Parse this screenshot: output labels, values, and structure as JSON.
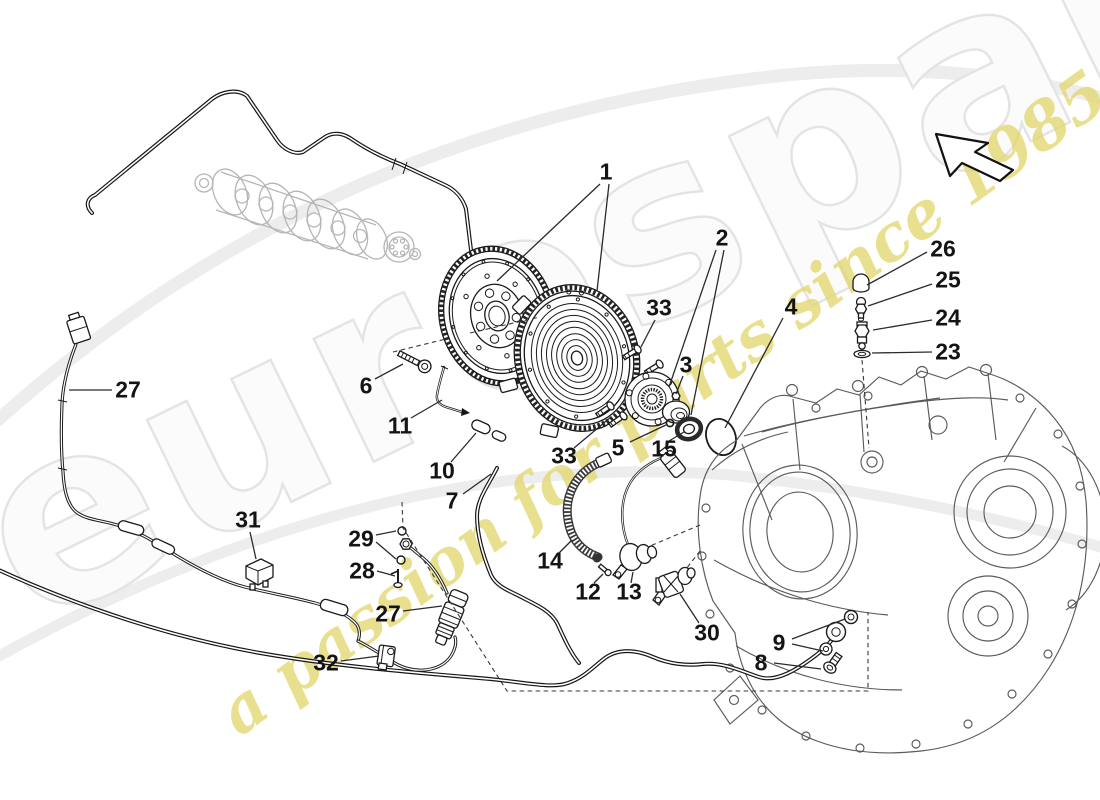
{
  "watermark": {
    "brand": "eurospares",
    "tagline": "a passion for parts since 1985",
    "brand_color": "#f0f0f0",
    "tagline_color": "#e2d76e"
  },
  "colors": {
    "background": "#ffffff",
    "line_art": "#1a1a1a",
    "housing_gray": "#5b5b5b",
    "crankshaft_gray": "#b6b6b6",
    "swoosh_gray": "#ededed",
    "label_text": "#141414"
  },
  "icons": {
    "direction_arrow": "arrow-up-left-icon"
  },
  "callouts": [
    {
      "text": "1",
      "x": 606,
      "y": 172,
      "leaders": [
        [
          600,
          184,
          497,
          281
        ],
        [
          609,
          184,
          597,
          291
        ]
      ]
    },
    {
      "text": "2",
      "x": 722,
      "y": 238,
      "leaders": [
        [
          716,
          250,
          669,
          387
        ],
        [
          724,
          250,
          691,
          415
        ]
      ]
    },
    {
      "text": "3",
      "x": 686,
      "y": 365,
      "leaders": [
        [
          683,
          376,
          676,
          394
        ]
      ]
    },
    {
      "text": "4",
      "x": 791,
      "y": 307,
      "leaders": [
        [
          783,
          318,
          725,
          428
        ]
      ]
    },
    {
      "text": "5",
      "x": 618,
      "y": 448,
      "leaders": [
        [
          630,
          442,
          666,
          425
        ]
      ]
    },
    {
      "text": "6",
      "x": 366,
      "y": 386,
      "leaders": [
        [
          375,
          379,
          403,
          364
        ]
      ]
    },
    {
      "text": "7",
      "x": 452,
      "y": 501,
      "leaders": [
        [
          463,
          494,
          491,
          474
        ]
      ]
    },
    {
      "text": "8",
      "x": 761,
      "y": 663,
      "leaders": [
        [
          774,
          663,
          821,
          669
        ]
      ]
    },
    {
      "text": "9",
      "x": 779,
      "y": 643,
      "leaders": [
        [
          792,
          639,
          845,
          619
        ],
        [
          792,
          644,
          823,
          651
        ]
      ]
    },
    {
      "text": "10",
      "x": 442,
      "y": 471,
      "leaders": [
        [
          451,
          462,
          476,
          433
        ]
      ]
    },
    {
      "text": "11",
      "x": 400,
      "y": 426,
      "leaders": [
        [
          411,
          418,
          442,
          400
        ]
      ]
    },
    {
      "text": "12",
      "x": 588,
      "y": 592,
      "leaders": [
        [
          594,
          583,
          603,
          574
        ]
      ]
    },
    {
      "text": "13",
      "x": 629,
      "y": 592,
      "leaders": [
        [
          631,
          583,
          633,
          572
        ]
      ]
    },
    {
      "text": "14",
      "x": 550,
      "y": 561,
      "leaders": [
        [
          559,
          553,
          572,
          540
        ]
      ]
    },
    {
      "text": "15",
      "x": 664,
      "y": 449,
      "leaders": [
        [
          669,
          441,
          684,
          432
        ]
      ]
    },
    {
      "text": "23",
      "x": 948,
      "y": 352,
      "leaders": [
        [
          932,
          352,
          872,
          353
        ]
      ]
    },
    {
      "text": "24",
      "x": 948,
      "y": 318,
      "leaders": [
        [
          932,
          320,
          873,
          330
        ]
      ]
    },
    {
      "text": "25",
      "x": 948,
      "y": 280,
      "leaders": [
        [
          932,
          284,
          868,
          306
        ]
      ]
    },
    {
      "text": "26",
      "x": 943,
      "y": 249,
      "leaders": [
        [
          927,
          252,
          867,
          285
        ]
      ]
    },
    {
      "text": "27",
      "x": 128,
      "y": 390,
      "leaders": [
        [
          112,
          390,
          69,
          390
        ]
      ]
    },
    {
      "text": "27",
      "x": 388,
      "y": 614,
      "leaders": [
        [
          403,
          611,
          442,
          606
        ]
      ]
    },
    {
      "text": "28",
      "x": 362,
      "y": 571,
      "leaders": [
        [
          377,
          571,
          395,
          576
        ]
      ]
    },
    {
      "text": "29",
      "x": 361,
      "y": 539,
      "leaders": [
        [
          376,
          535,
          396,
          531
        ],
        [
          376,
          542,
          396,
          559
        ]
      ]
    },
    {
      "text": "30",
      "x": 707,
      "y": 633,
      "leaders": [
        [
          699,
          623,
          680,
          594
        ]
      ]
    },
    {
      "text": "31",
      "x": 248,
      "y": 520,
      "leaders": [
        [
          250,
          532,
          256,
          559
        ]
      ]
    },
    {
      "text": "32",
      "x": 326,
      "y": 663,
      "leaders": [
        [
          341,
          661,
          379,
          656
        ]
      ]
    },
    {
      "text": "33",
      "x": 659,
      "y": 308,
      "leaders": [
        [
          655,
          320,
          641,
          347
        ]
      ]
    },
    {
      "text": "33",
      "x": 564,
      "y": 456,
      "leaders": [
        [
          574,
          448,
          611,
          417
        ]
      ]
    }
  ]
}
